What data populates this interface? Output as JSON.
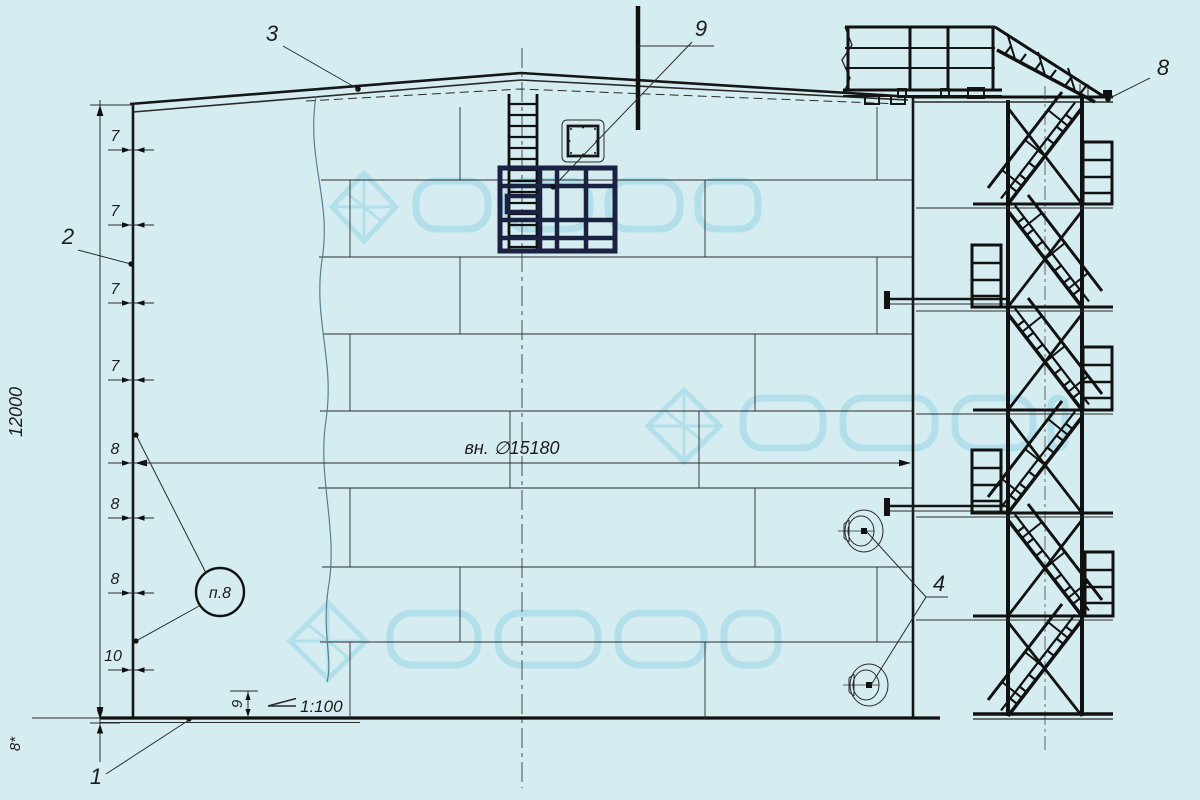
{
  "drawing": {
    "title": "vertical-tank-elevation",
    "colors": {
      "background": "#d5edf1",
      "line": "#161616",
      "cage_navy": "#1b2140",
      "watermark": "#aedde9",
      "break_line": "#55808f"
    },
    "labels": {
      "pos_1": "1",
      "pos_2": "2",
      "pos_3": "3",
      "pos_4": "4",
      "pos_8": "8",
      "pos_9": "9"
    },
    "dimensions": {
      "height": "12000",
      "bottom_thickness": "8*",
      "inner_diameter": "вн. ∅15180",
      "slope": "1:100",
      "bottom_rise": "9"
    },
    "course_thicknesses": [
      "7",
      "7",
      "7",
      "7",
      "8",
      "8",
      "8",
      "10"
    ],
    "note_circle": "п.8"
  }
}
